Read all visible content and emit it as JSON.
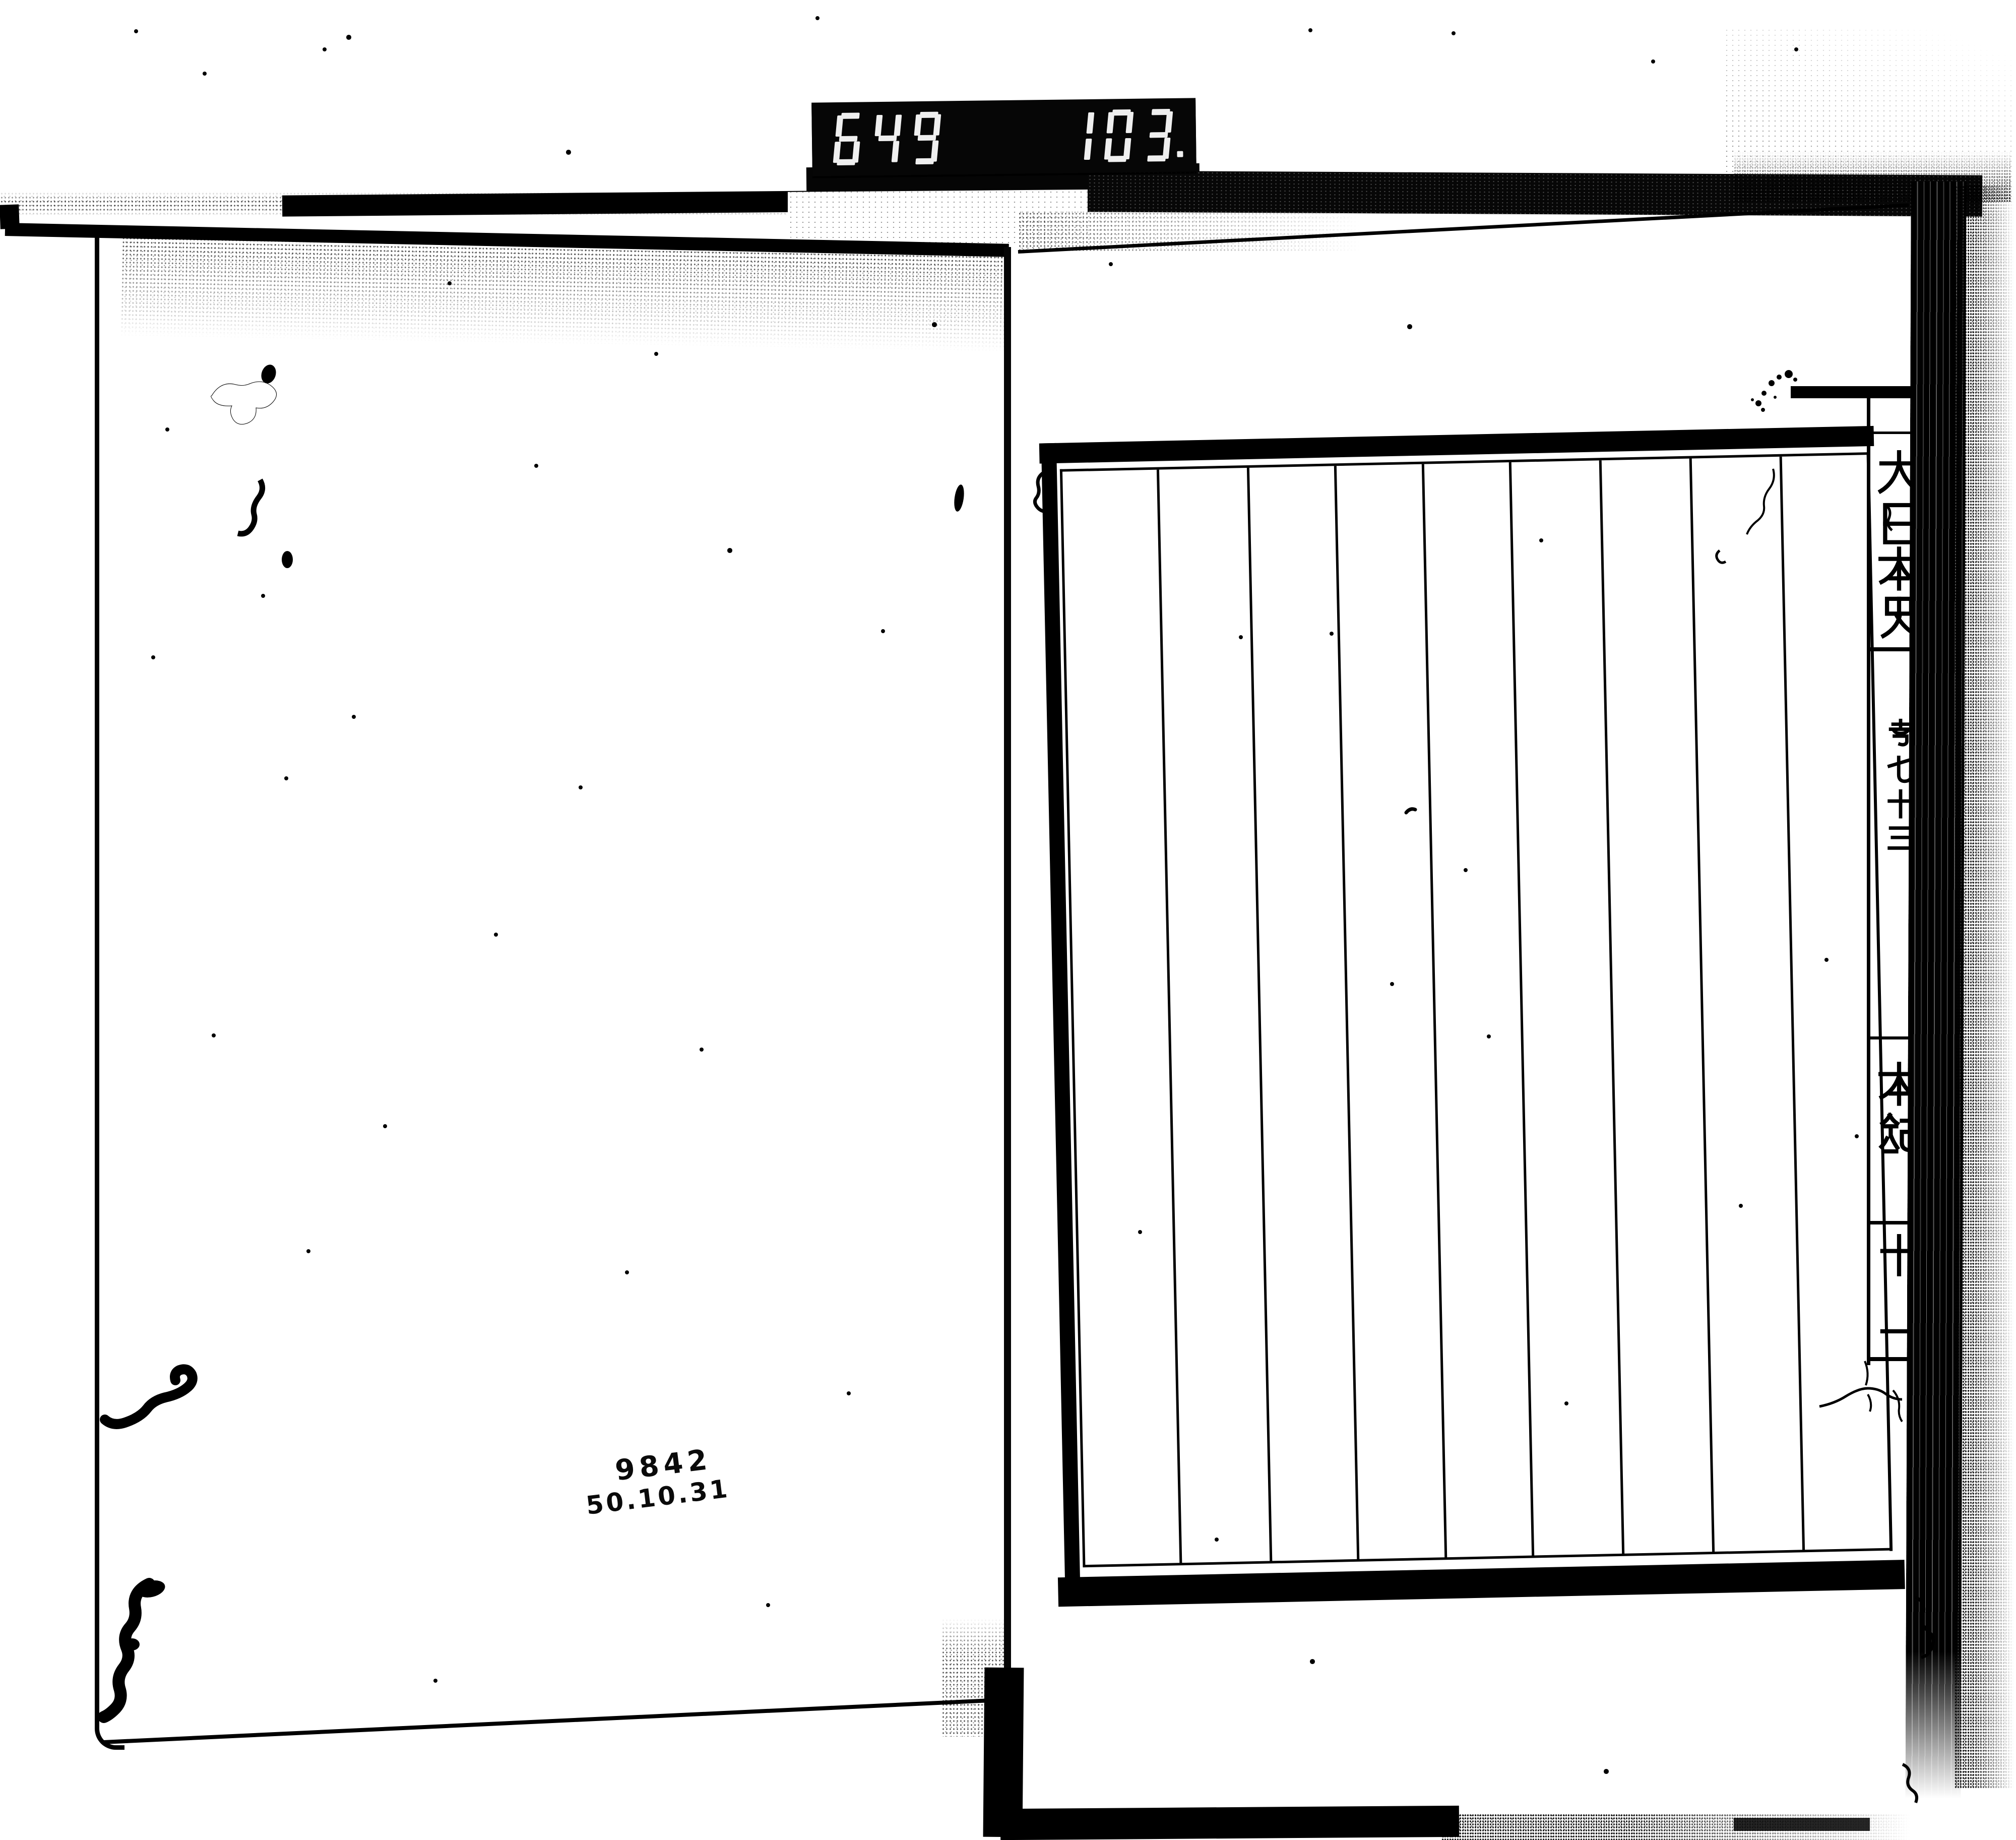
{
  "counter": {
    "left_value": "649",
    "right_value": "103.",
    "display_style": "seven-segment"
  },
  "stamp": {
    "line1": "9842",
    "line2": "50.10.31"
  },
  "spine": {
    "title": "大日本史",
    "title_chars": [
      "大",
      "日",
      "本",
      "史"
    ],
    "volume_chars": [
      "卷",
      "七",
      "十",
      "三"
    ],
    "section_chars": [
      "本",
      "紀"
    ],
    "number_chars": [
      "十",
      "一"
    ]
  },
  "colors": {
    "ink": "#000000",
    "paper": "#ffffff",
    "counter_background": "#060606",
    "counter_segment": "#efefef"
  }
}
